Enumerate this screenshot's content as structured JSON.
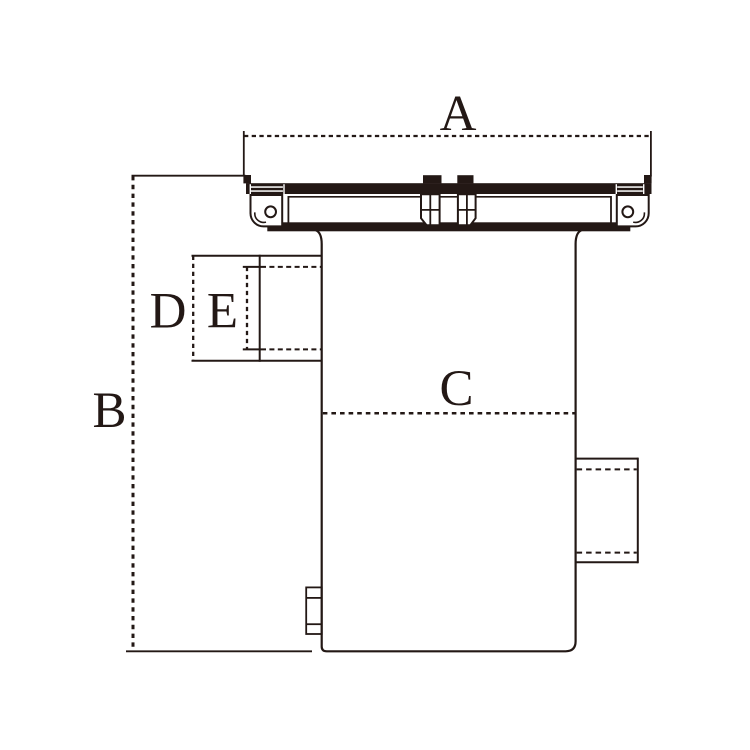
{
  "diagram": {
    "type": "technical-dimension-drawing",
    "dimension_labels": {
      "a": "A",
      "b": "B",
      "c": "C",
      "d": "D",
      "e": "E"
    }
  },
  "colors": {
    "ink": "#231815",
    "background": "#ffffff"
  }
}
